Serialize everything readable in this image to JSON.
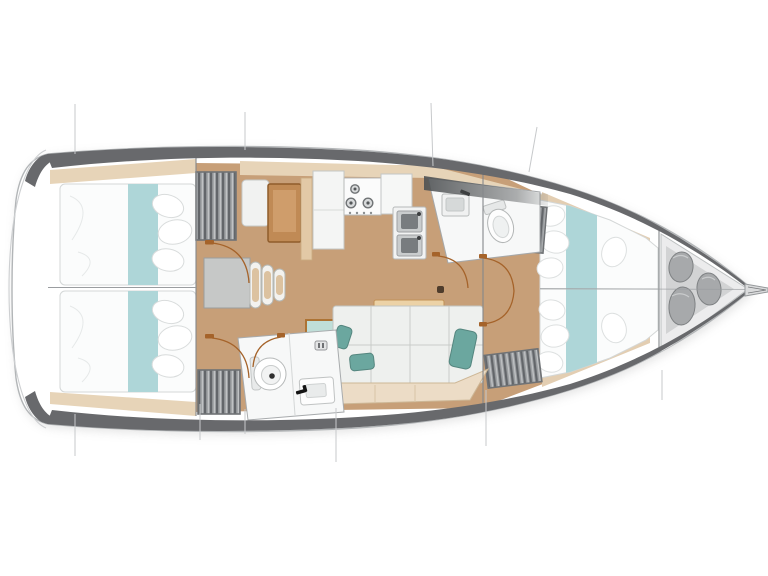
{
  "diagram": {
    "type": "yacht-floor-plan",
    "description": "Top-down interior layout plan of a sailing yacht, bow pointing right",
    "areas": [
      {
        "name": "aft-cabin-port",
        "feature": "double berth with teal runner and pillows"
      },
      {
        "name": "aft-cabin-starboard",
        "feature": "double berth with teal runner and pillows"
      },
      {
        "name": "nav-station",
        "feature": "chart table with seat"
      },
      {
        "name": "companionway",
        "feature": "entry steps with three treads"
      },
      {
        "name": "galley",
        "feature": "three-burner stove, counters, double sink"
      },
      {
        "name": "salon",
        "feature": "settee with teal cushions and dining table"
      },
      {
        "name": "aft-head",
        "feature": "toilet and sink"
      },
      {
        "name": "forward-head",
        "feature": "toilet and sink"
      },
      {
        "name": "forward-cabin",
        "feature": "V-berth with teal runner and pillows"
      },
      {
        "name": "sail-locker",
        "feature": "bow locker with three fender bags"
      }
    ],
    "icons": [
      "stove-burner-icon",
      "faucet-icon",
      "vent-icon",
      "mast-step-icon",
      "door-swing-icon"
    ]
  },
  "colors": {
    "teal_runner": "#aed6d8",
    "teal_pillow": "#6ba79f",
    "wood_floor": "#c79f78",
    "wood_furniture": "#c08a55",
    "table_wood": "#ecd2a6",
    "shelf_beige": "#e7d4b8",
    "seat_base_beige": "#ecdcc6",
    "hull_band": "#68696c",
    "hull_outline": "#b2b5b7",
    "locker_gray": "#9b9ea1",
    "fixture_white": "#f6f7f7",
    "cushion_white": "#eef0ee",
    "bag_gray": "#a7a9ab",
    "door_arc_brown": "#a5632a",
    "section_line_gray": "#c7c9cb"
  }
}
